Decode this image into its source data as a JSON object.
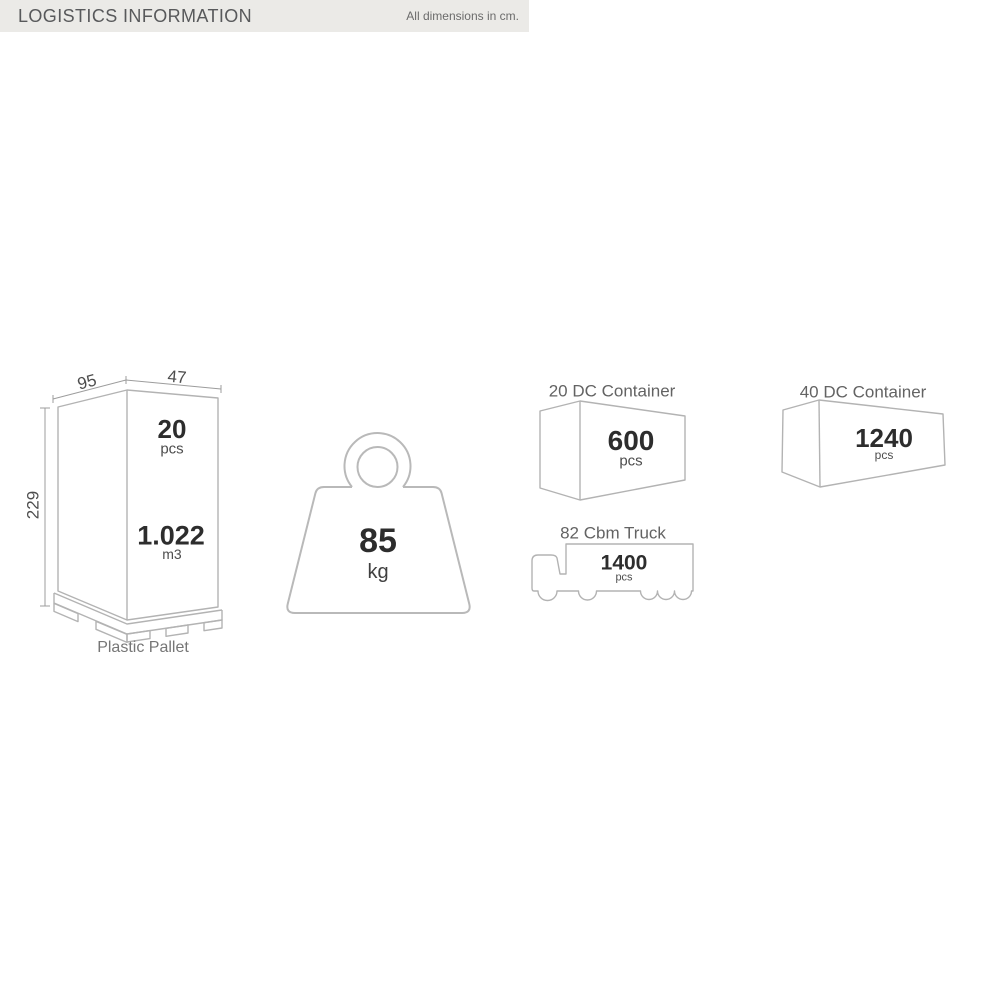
{
  "header": {
    "title": "LOGISTICS INFORMATION",
    "note": "All dimensions in cm."
  },
  "pallet": {
    "dim_width": "95",
    "dim_depth": "47",
    "dim_height": "229",
    "qty_value": "20",
    "qty_unit": "pcs",
    "volume_value": "1.022",
    "volume_unit": "m3",
    "caption": "Plastic Pallet"
  },
  "weight": {
    "value": "85",
    "unit": "kg"
  },
  "container20": {
    "title": "20 DC Container",
    "qty": "600",
    "unit": "pcs"
  },
  "container40": {
    "title": "40 DC Container",
    "qty": "1240",
    "unit": "pcs"
  },
  "truck": {
    "title": "82 Cbm Truck",
    "qty": "1400",
    "unit": "pcs"
  },
  "colors": {
    "outline": "#b3b3b3",
    "dimension_line": "#9c9c9c",
    "number_text": "#2d2d2d",
    "label_text": "#6e6e6e",
    "header_bg": "#ebeae7",
    "header_text": "#58595b"
  }
}
